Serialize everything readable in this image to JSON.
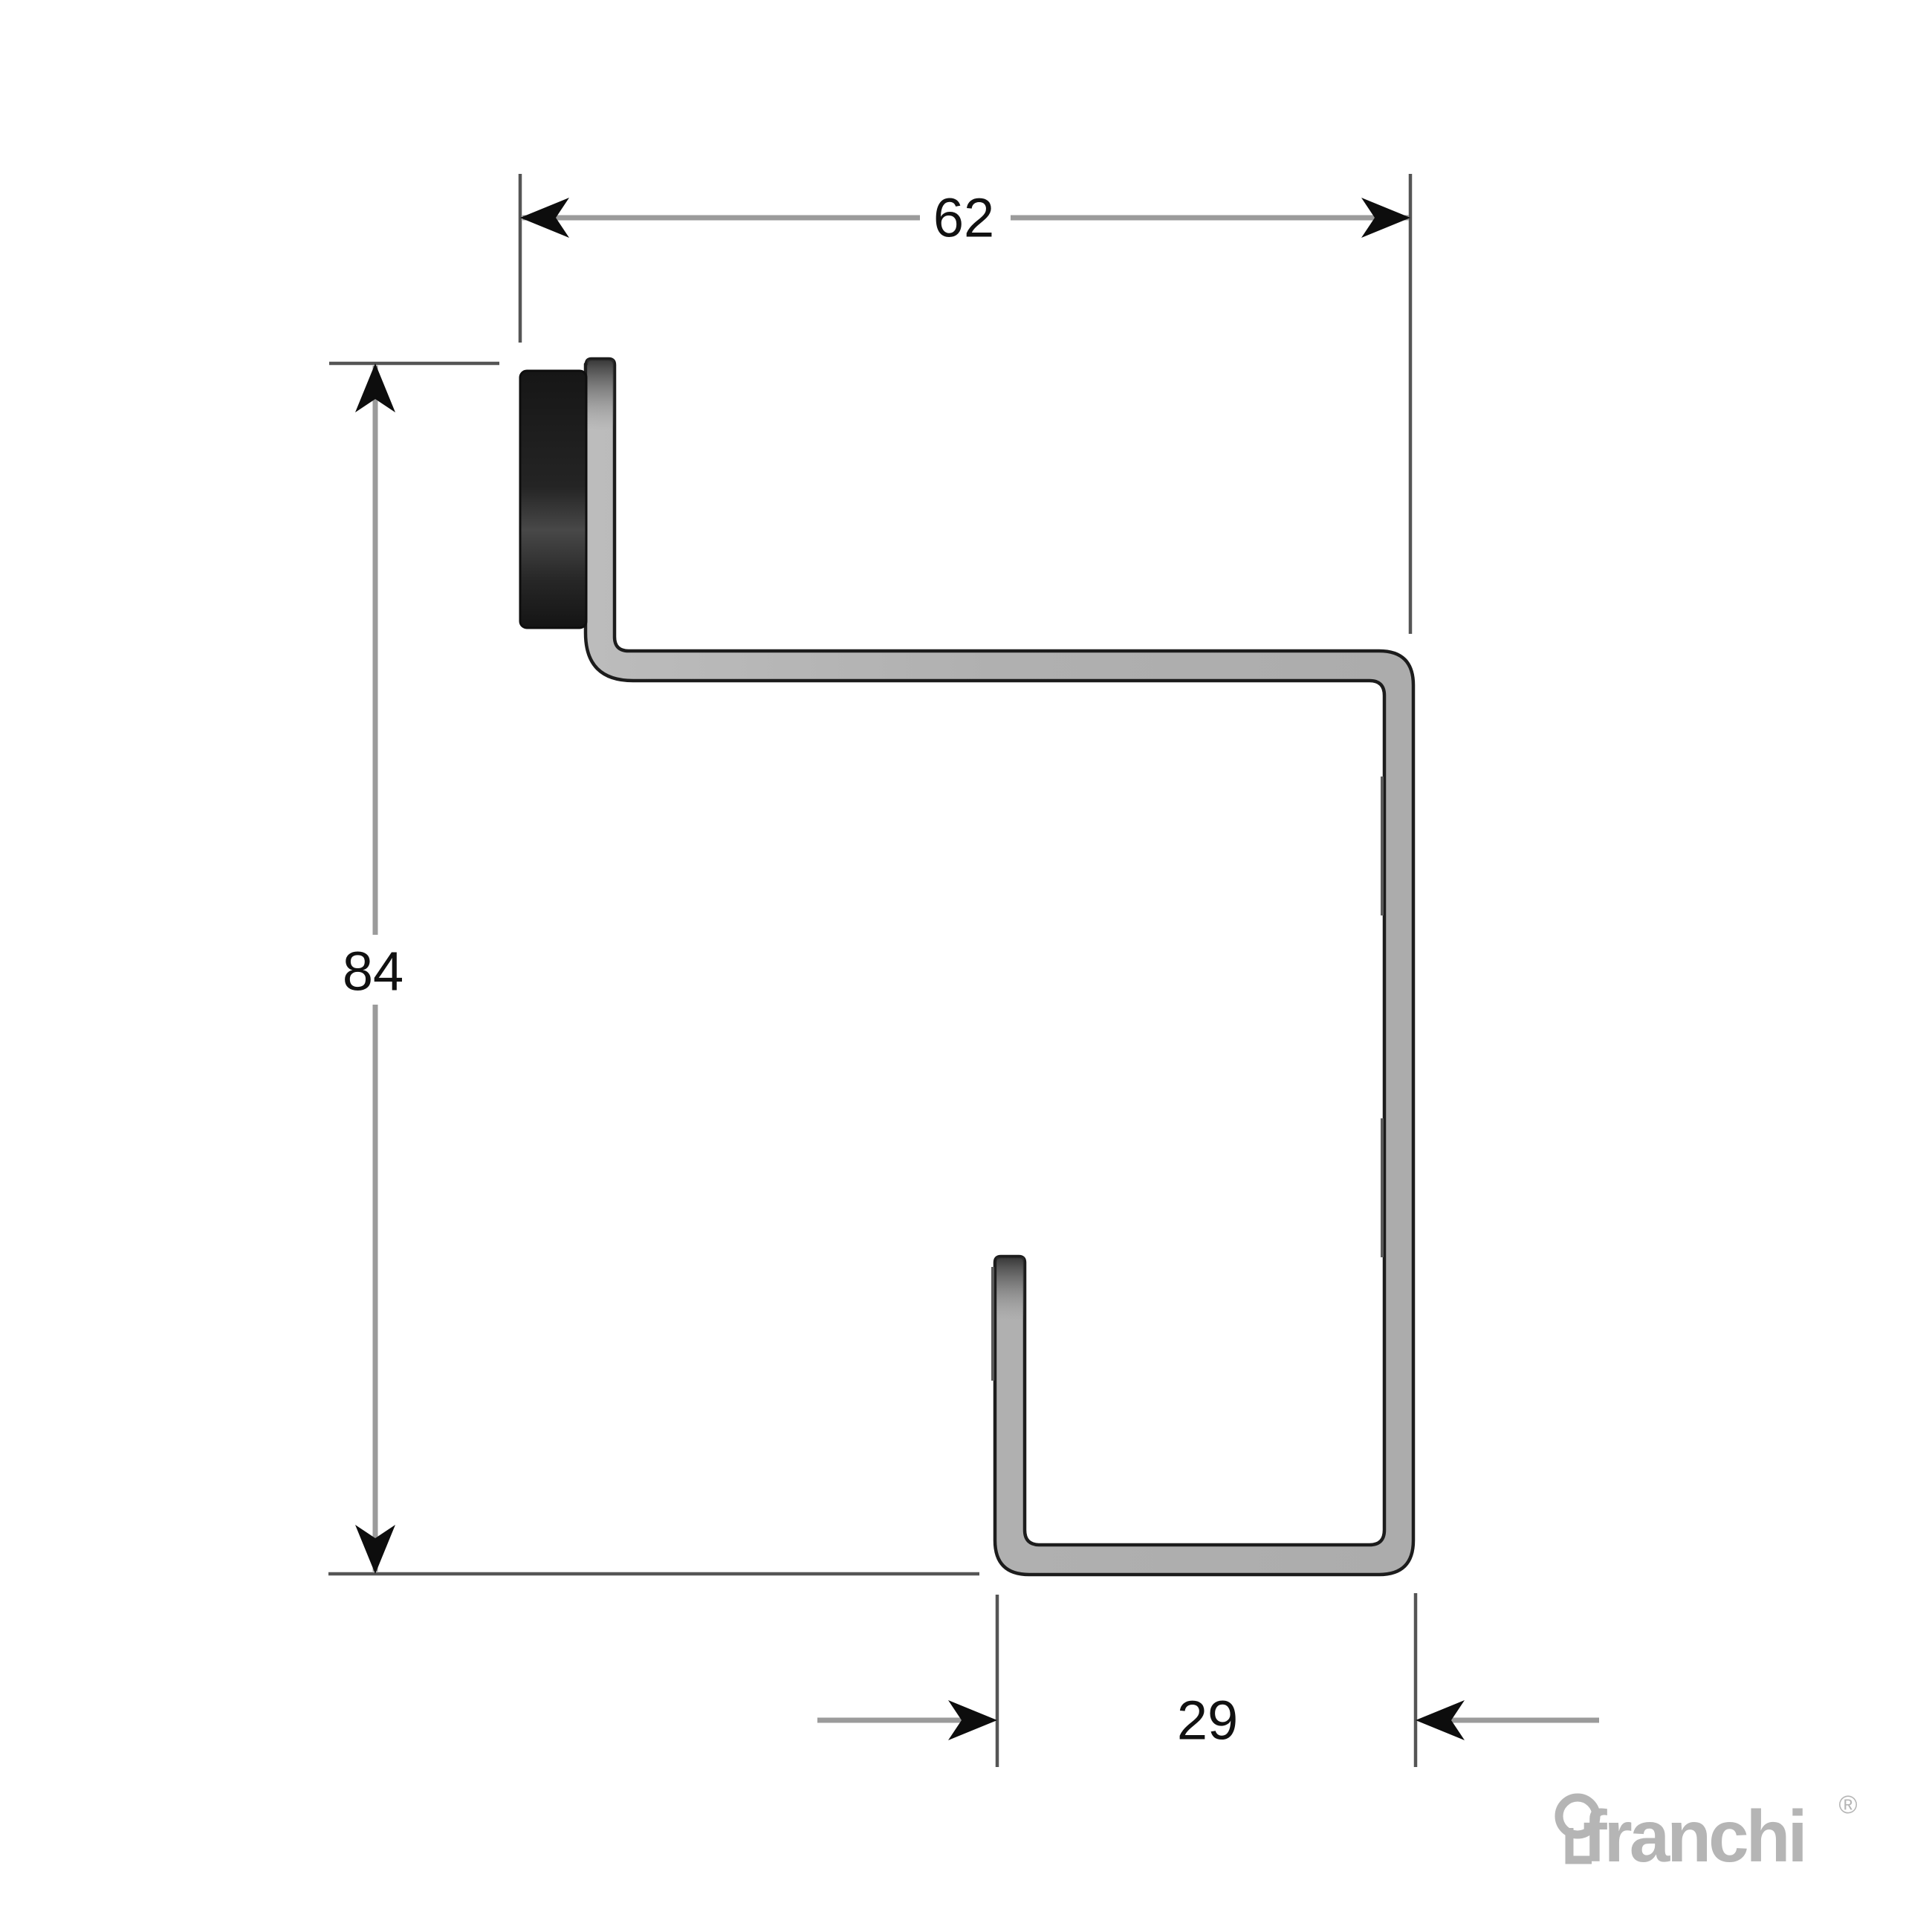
{
  "diagram": {
    "type": "technical-profile-cross-section",
    "dimensions": {
      "top_width": "62",
      "left_height": "84",
      "bottom_width": "29"
    }
  },
  "logo": {
    "text": "franchi",
    "registered_mark": "®"
  },
  "icons": {
    "keyhole_icon": "franchi keyhole brand mark"
  },
  "colors": {
    "background": "#ffffff",
    "profile_fill": "#b3b3b3",
    "profile_outline": "#1c1c1c",
    "gasket_dark": "#1a1a1a",
    "dimension_line": "#9b9b9b",
    "extension_line": "#555555",
    "arrowhead": "#0d0d0d",
    "dimension_text": "#111111",
    "logo_gray": "#b5b5b5"
  }
}
